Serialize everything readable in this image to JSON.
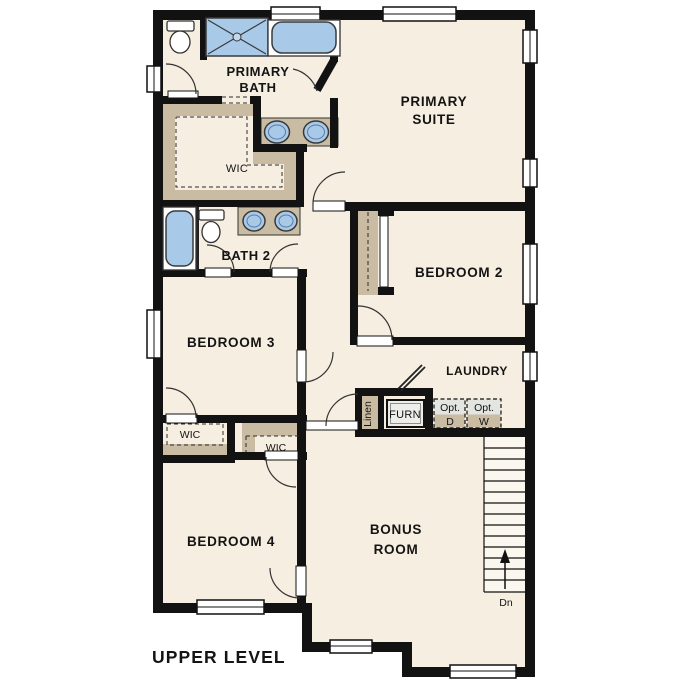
{
  "plan": {
    "level_title": "UPPER LEVEL",
    "stairs_direction_label": "Dn",
    "rooms": {
      "primary_bath": {
        "line1": "PRIMARY",
        "line2": "BATH"
      },
      "primary_suite": {
        "line1": "PRIMARY",
        "line2": "SUITE"
      },
      "primary_wic": {
        "label": "WIC"
      },
      "bath_2": {
        "label": "BATH 2"
      },
      "bedroom_2": {
        "label": "BEDROOM 2"
      },
      "bedroom_3": {
        "label": "BEDROOM 3"
      },
      "laundry": {
        "label": "LAUNDRY"
      },
      "linen": {
        "label": "Linen"
      },
      "furnace": {
        "label": "FURN"
      },
      "optional_dryer": {
        "line1": "Opt.",
        "line2": "D"
      },
      "optional_washer": {
        "line1": "Opt.",
        "line2": "W"
      },
      "wic_bedroom_3": {
        "label": "WIC"
      },
      "wic_bedroom_4": {
        "label": "WIC"
      },
      "bedroom_4": {
        "label": "BEDROOM 4"
      },
      "bonus_room": {
        "line1": "BONUS",
        "line2": "ROOM"
      }
    },
    "colors": {
      "floor": "#f5eee1",
      "wall": "#121212",
      "closet_tan": "#c9bca3",
      "fixture_blue": "#a9c9e9",
      "optional_gray": "#e2e5e0",
      "stairs_fill": "#fbf7ee"
    }
  }
}
